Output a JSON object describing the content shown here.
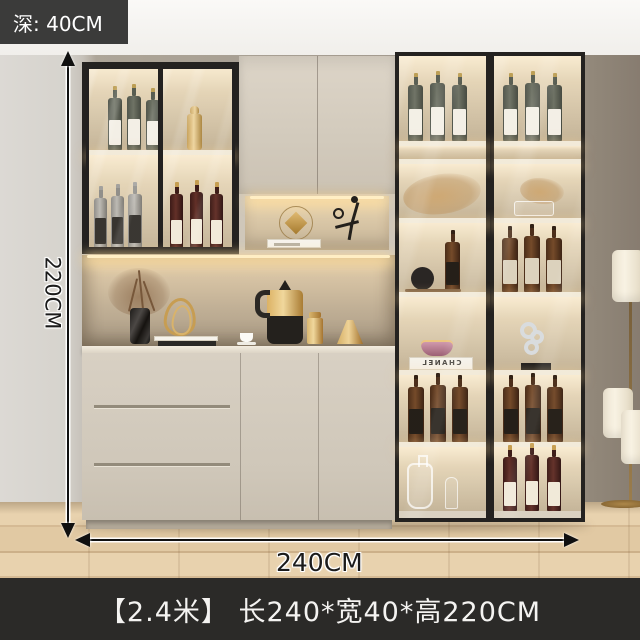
{
  "annotations": {
    "depth_label": "深: 40CM",
    "height_label": "220CM",
    "width_label": "240CM"
  },
  "caption": "【2.4米】 长240*宽40*高220CM",
  "decor": {
    "book_brand": "CHANEL"
  },
  "colors": {
    "depth_label_bg": "#3b3b3a",
    "caption_bg": "#2b2a28",
    "annotation_text": "#1b1b1b",
    "label_text": "#ffffff",
    "cabinet_frame": "#242220",
    "cabinet_body": "#d3cbbe",
    "led_glow": "#ffe9bf",
    "accent_gold": "#c79d52",
    "wall_right": "#8e8379",
    "floor_wood": "#ddc49f"
  }
}
